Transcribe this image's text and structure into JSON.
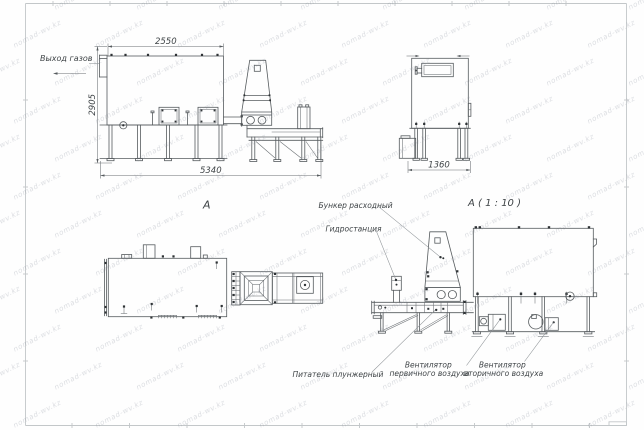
{
  "watermark": {
    "text": "nomad-wv.kz"
  },
  "colors": {
    "line": "#565b5e",
    "frame": "#c3c7c9",
    "text": "#3f4447"
  },
  "front_view": {
    "gas_outlet_label": "Выход газов",
    "dim_top": "2550",
    "dim_height": "2905",
    "dim_length": "5340",
    "view_label": "А"
  },
  "end_view": {
    "dim_width": "1360"
  },
  "section_view": {
    "title": "А ( 1 : 10 )",
    "hopper_label": "Бункер расходный",
    "hydro_label": "Гидростанция",
    "feeder_label": "Питатель плунжерный",
    "fan_primary_line1": "Вентилятор",
    "fan_primary_line2": "первичного воздуха",
    "fan_secondary_line1": "Вентилятор",
    "fan_secondary_line2": "вторичного воздуха"
  }
}
